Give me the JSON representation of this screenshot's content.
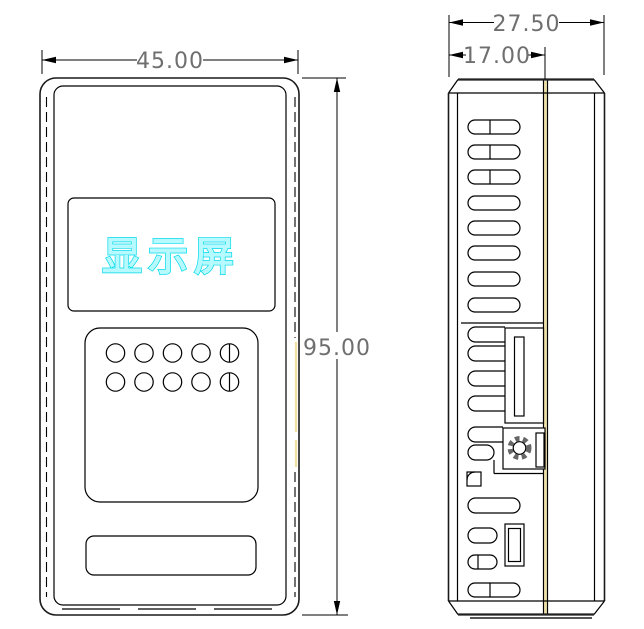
{
  "front_view": {
    "width_dim": "45.00",
    "height_dim": "95.00",
    "display_label": "显示屏"
  },
  "side_view": {
    "outer_depth_dim": "27.50",
    "inner_depth_dim": "17.00"
  },
  "colors": {
    "line": "#000000",
    "dim_text": "#6f6f6f",
    "display_text_fill": "#b6faff",
    "display_text_stroke": "#00d9e9",
    "highlight_yellow": "#f0dfa0",
    "ring_gray": "#666666"
  }
}
